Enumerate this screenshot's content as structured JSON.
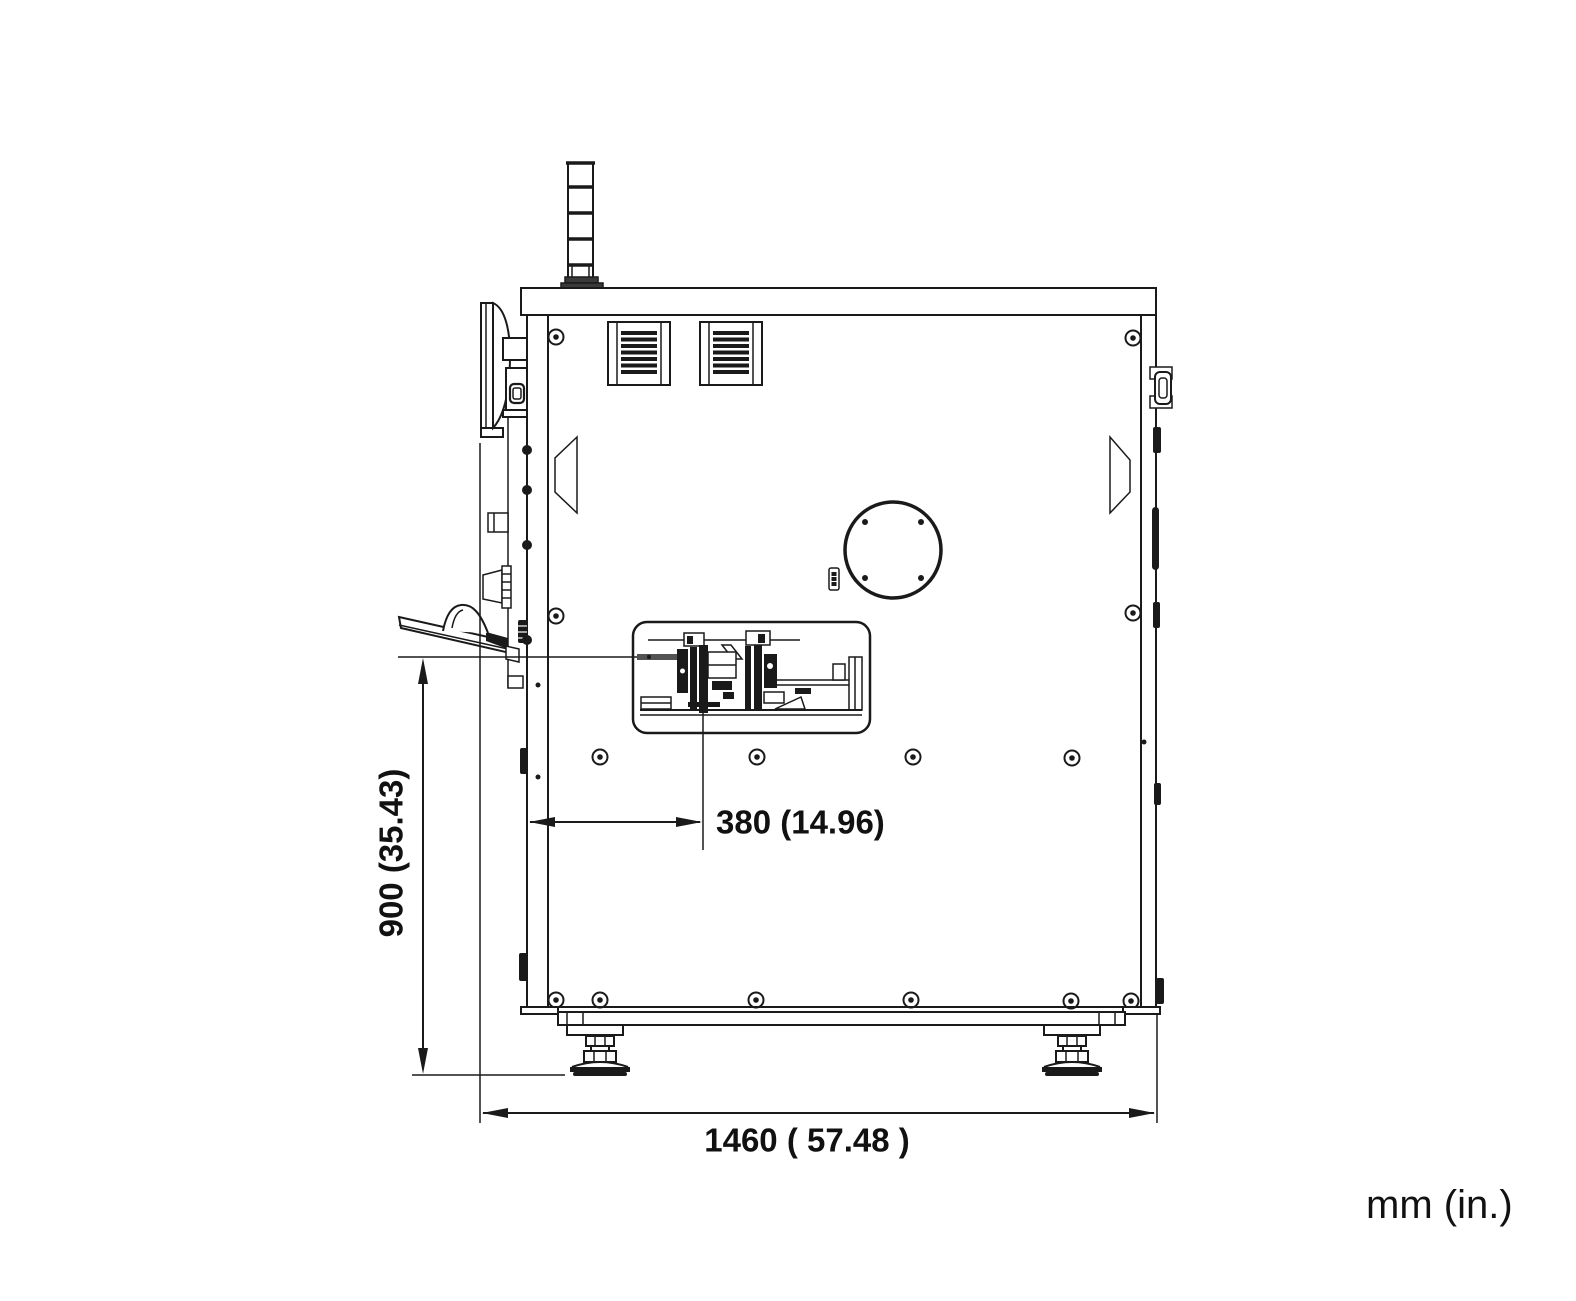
{
  "colors": {
    "ink": "#1a1a1a",
    "background": "#ffffff"
  },
  "dimensions": {
    "height": {
      "label": "900 (35.43)",
      "orientation": "vertical"
    },
    "offset": {
      "label": "380 (14.96)",
      "orientation": "horizontal"
    },
    "width": {
      "label": "1460 ( 57.48 )",
      "orientation": "horizontal"
    }
  },
  "units": {
    "label": "mm (in.)"
  }
}
